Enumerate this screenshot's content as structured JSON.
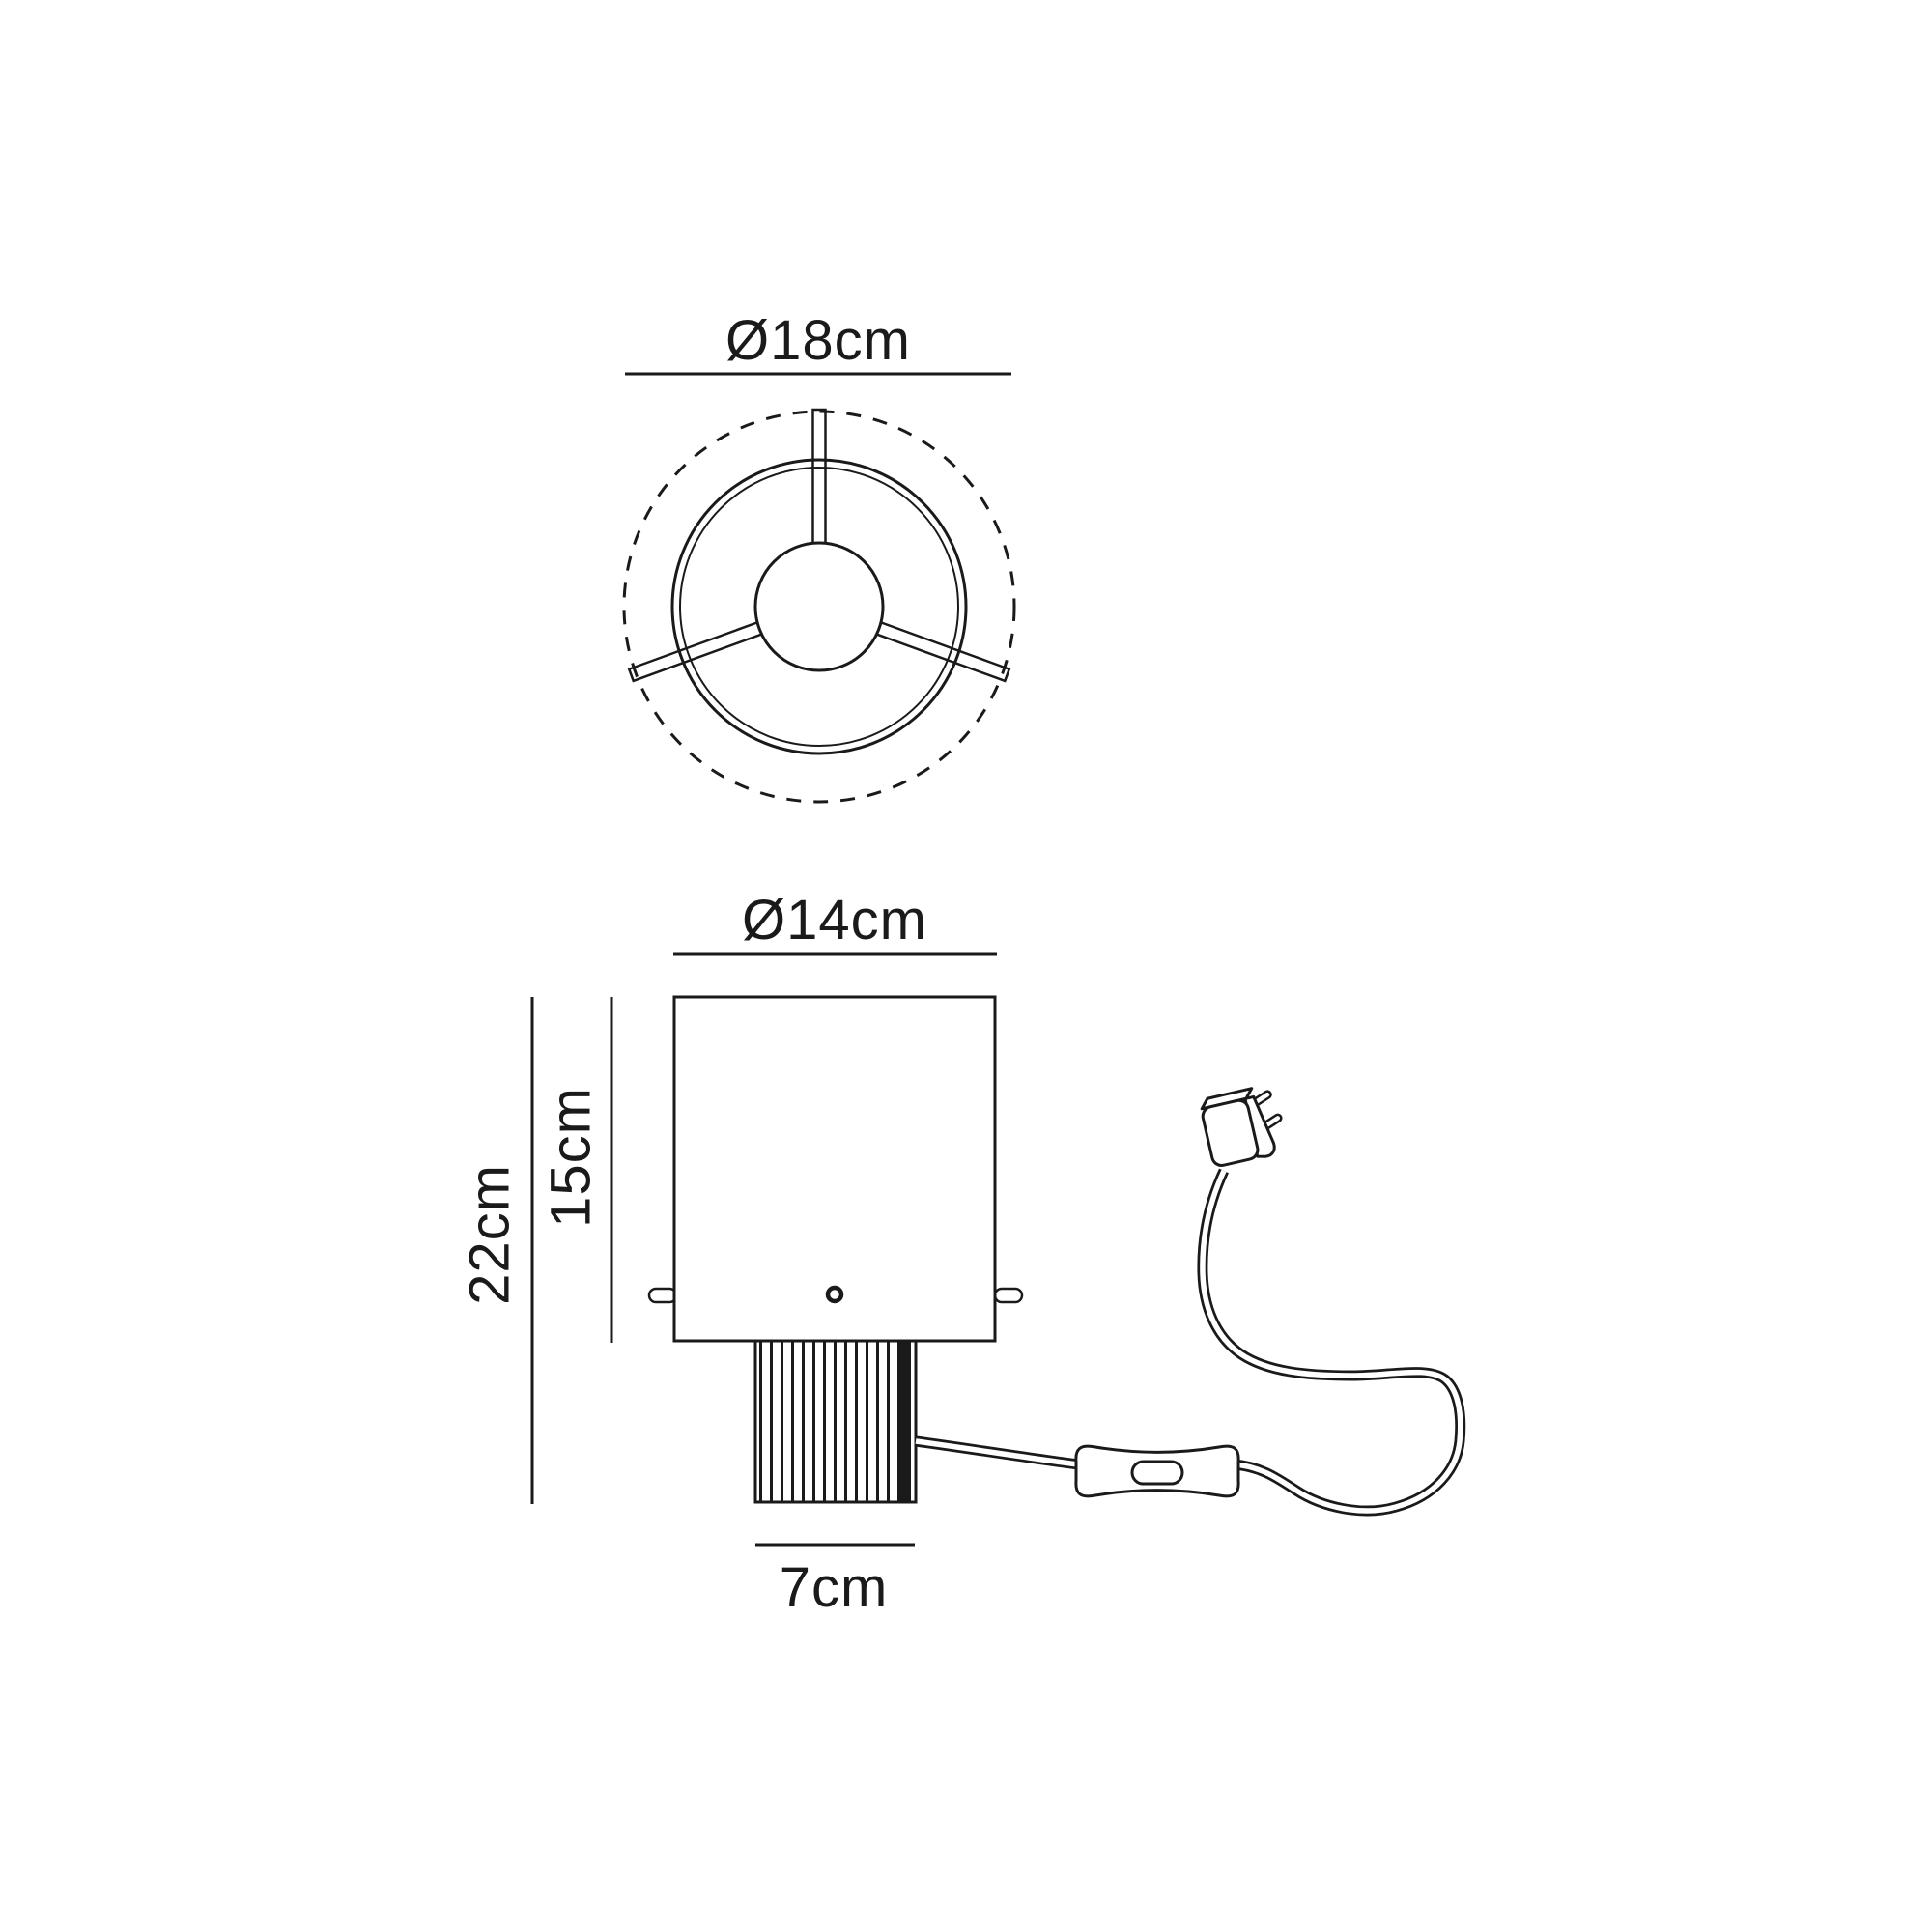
{
  "diagram": {
    "type": "product-dimension-drawing",
    "subject": "table-lamp",
    "labels": {
      "top_diameter": "Ø18cm",
      "shade_diameter": "Ø14cm",
      "total_height": "22cm",
      "shade_height": "15cm",
      "base_width": "7cm"
    },
    "colors": {
      "line": "#1a1a1a",
      "background": "#ffffff"
    }
  }
}
